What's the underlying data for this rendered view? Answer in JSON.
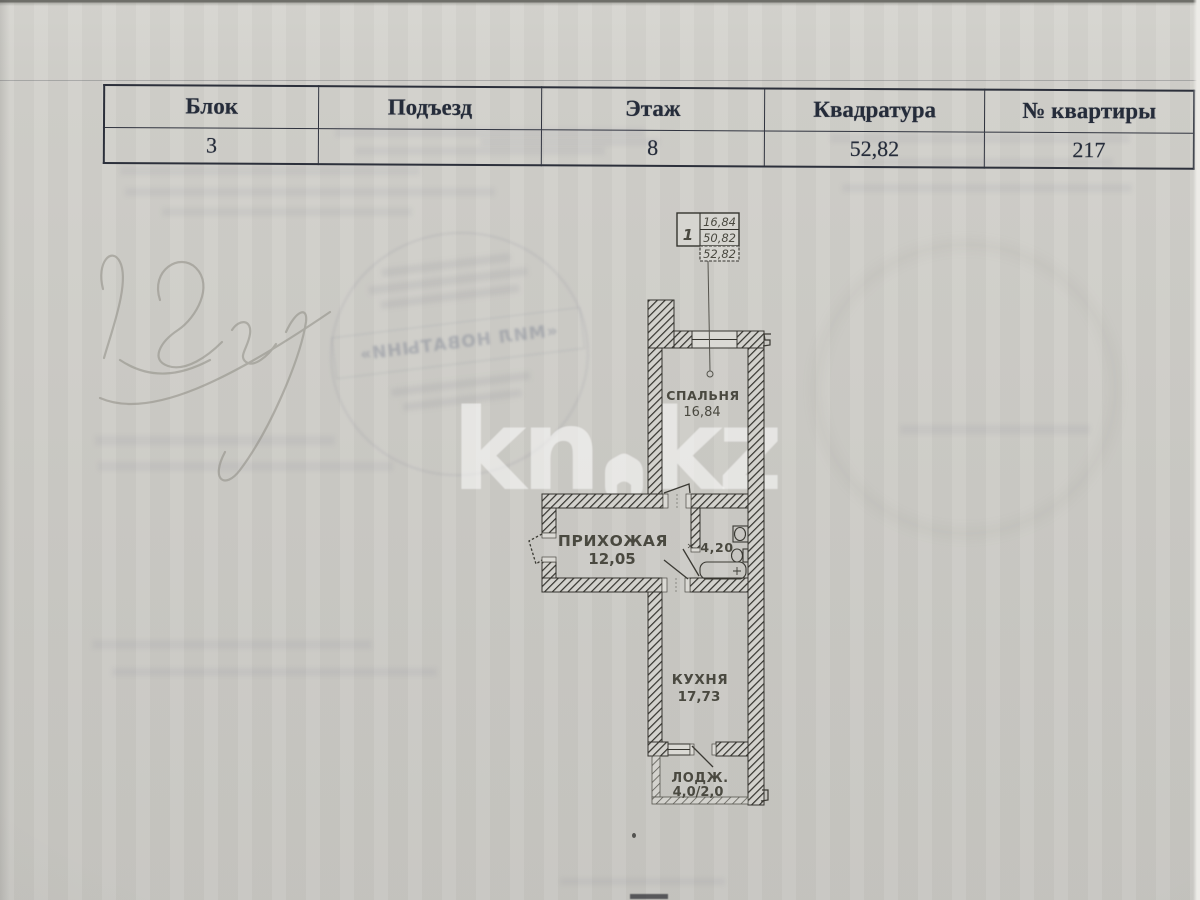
{
  "table": {
    "headers": [
      "Блок",
      "Подъезд",
      "Этаж",
      "Квадратура",
      "№ квартиры"
    ],
    "row": [
      "3",
      "",
      "8",
      "52,82",
      "217"
    ]
  },
  "watermark": {
    "left": "kn",
    "right": "kz"
  },
  "plan": {
    "legend": {
      "unit": "1",
      "row1": "16,84",
      "row2": "50,82",
      "row3": "52,82"
    },
    "bedroom": {
      "label": "СПАЛЬНЯ",
      "area": "16,84"
    },
    "hallway": {
      "label": "ПРИХОЖАЯ",
      "area": "12,05"
    },
    "bathroom": {
      "area": "4,20"
    },
    "kitchen": {
      "label": "КУХНЯ",
      "area": "17,73"
    },
    "loggia": {
      "label": "ЛОДЖ.",
      "area": "4,0/2,0"
    }
  },
  "stamp": {
    "text": "«МИЛ НОВАТЫНИ»"
  },
  "colors": {
    "paper": "#cecdc8",
    "plan_ink": "#37362f",
    "table_ink": "#252c3a",
    "watermark": "rgba(255,255,255,0.53)",
    "stamp_ink": "#545c76"
  }
}
